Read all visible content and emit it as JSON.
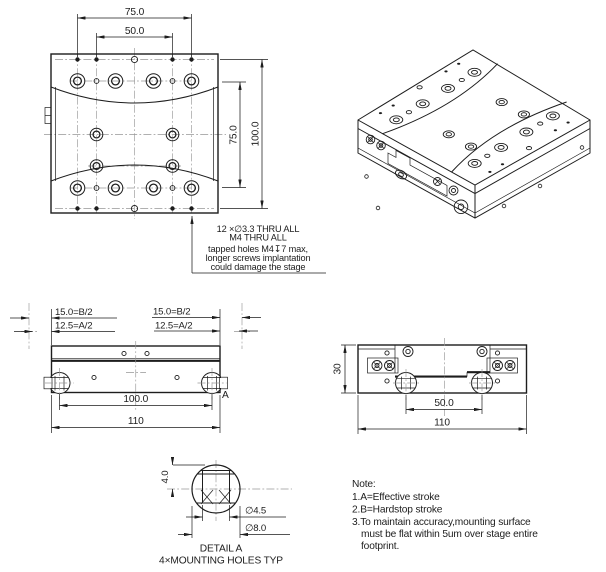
{
  "top_view": {
    "dim_width_outer": "75.0",
    "dim_width_inner": "50.0",
    "dim_height_inner": "75.0",
    "dim_height_outer": "100.0",
    "hole_callout": [
      "12 ×∅3.3 THRU ALL",
      "M4 THRU ALL",
      "tapped holes M4↧7 max,",
      "longer screws implantation",
      "could damage the stage"
    ]
  },
  "front_view": {
    "dim_hardstop_left": "15.0=B/2",
    "dim_effective_left": "12.5=A/2",
    "dim_hardstop_right": "15.0=B/2",
    "dim_effective_right": "12.5=A/2",
    "dim_hole_spacing": "100.0",
    "dim_overall_width": "110",
    "detail_marker": "A"
  },
  "side_view": {
    "dim_height": "30",
    "dim_hole_spacing": "50.0",
    "dim_overall_width": "110"
  },
  "detail_a": {
    "dim_depth": "4.0",
    "dim_hole_dia": "∅4.5",
    "dim_counterbore_dia": "∅8.0",
    "title": "DETAIL A",
    "subtitle": "4×MOUNTING HOLES TYP"
  },
  "notes": {
    "title": "Note:",
    "lines": [
      "1.A=Effective stroke",
      "2.B=Hardstop stroke",
      "3.To maintain accuracy,mounting surface",
      "must be flat within 5um over stage entire",
      "footprint."
    ]
  },
  "colors": {
    "line": "#1d1d1d",
    "centerline": "#979797",
    "background": "#ffffff"
  }
}
